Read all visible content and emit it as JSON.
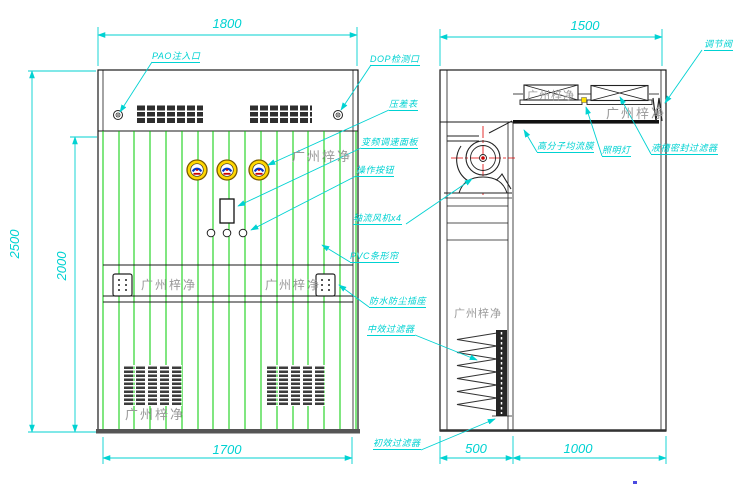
{
  "title_watermark": "广州梓净",
  "front_view": {
    "dimensions": {
      "top_width": "1800",
      "bottom_width": "1700",
      "overall_height": "2500",
      "opening_height": "2000"
    },
    "callouts": {
      "pao_port": "PAO注入口",
      "dop_port": "DOP检测口",
      "pressure_gauge": "压差表",
      "vfd_panel": "变频调速面板",
      "control_buttons": "操作按钮",
      "axial_fans": "轴流风机x4",
      "pvc_curtain": "PVC条形帘",
      "socket": "防水防尘插座",
      "medium_filter": "中效过滤器",
      "primary_filter": "初效过滤器"
    }
  },
  "side_view": {
    "dimensions": {
      "top_width": "1500",
      "rear_depth": "500",
      "front_depth": "1000"
    },
    "callouts": {
      "flow_membrane": "高分子均流膜",
      "lamp": "照明灯",
      "sealed_filter": "液槽密封过滤器",
      "damper": "调节阀"
    }
  },
  "colors": {
    "annotation": "#00d2d2",
    "curtain": "#00cc00",
    "centerline": "#e00000",
    "lamp": "#ffe100",
    "watermark": "#999999"
  }
}
